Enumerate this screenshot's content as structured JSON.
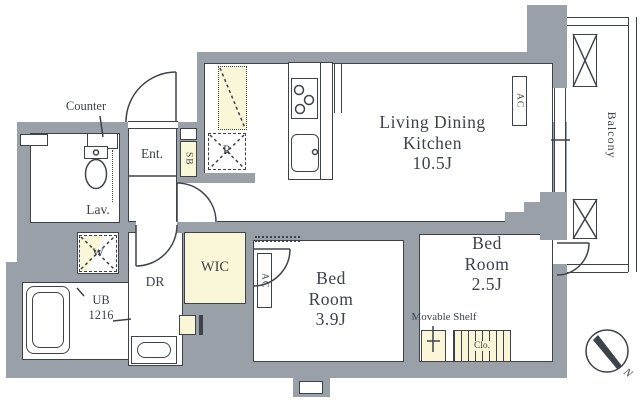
{
  "colors": {
    "wall": "#9aa0a7",
    "line": "#3e434b",
    "accent_yellow": "#faf6d8",
    "text": "#3e434b"
  },
  "rooms": {
    "ldk": {
      "line1": "Living Dining",
      "line2": "Kitchen",
      "line3": "10.5J"
    },
    "bed39": {
      "line1": "Bed",
      "line2": "Room",
      "line3": "3.9J"
    },
    "bed25": {
      "line1": "Bed",
      "line2": "Room",
      "line3": "2.5J"
    },
    "wic": {
      "label": "WIC"
    },
    "dr": {
      "label": "DR"
    },
    "ent": {
      "label": "Ent."
    },
    "lav": {
      "label": "Lav."
    },
    "ub": {
      "line1": "UB",
      "line2": "1216"
    },
    "balcony": {
      "label": "Balcony"
    }
  },
  "fixtures": {
    "counter": "Counter",
    "shoe_box": "SB",
    "refrigerator": "R",
    "washer": "W",
    "ac": "AC",
    "movable_shelf": "Movable Shelf",
    "closet": "Clo.",
    "north": "N"
  }
}
